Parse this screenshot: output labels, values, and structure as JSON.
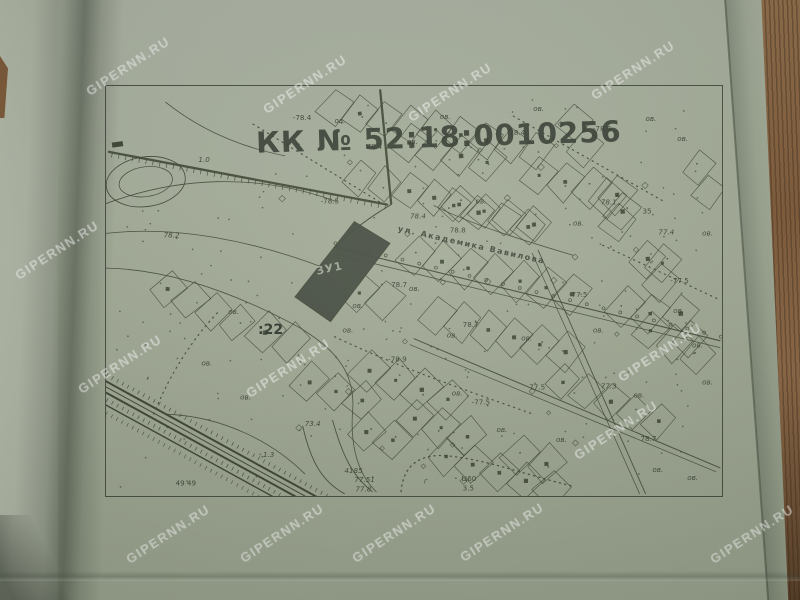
{
  "photo": {
    "watermark_text": "GIPERNN.RU",
    "watermarks": [
      {
        "x": 128,
        "y": 66
      },
      {
        "x": 305,
        "y": 84
      },
      {
        "x": 450,
        "y": 92
      },
      {
        "x": 633,
        "y": 70
      },
      {
        "x": 57,
        "y": 250
      },
      {
        "x": 120,
        "y": 364
      },
      {
        "x": 288,
        "y": 368
      },
      {
        "x": 660,
        "y": 352
      },
      {
        "x": 616,
        "y": 430
      },
      {
        "x": 168,
        "y": 534
      },
      {
        "x": 282,
        "y": 533
      },
      {
        "x": 394,
        "y": 533
      },
      {
        "x": 502,
        "y": 532
      },
      {
        "x": 752,
        "y": 534
      }
    ],
    "colors": {
      "paper": "#a2aa96",
      "ink": "#3a412f",
      "wood": "#7c5634",
      "highlight_parcel": "#434a3e"
    }
  },
  "map": {
    "title": "КК № 52:18:0010256",
    "quarter_label": ":22",
    "highlight_parcel_label": "ЗУ1",
    "street_label": "ул. Академика Вавилова",
    "point_labels": [
      {
        "x": 93,
        "y": 76,
        "t": "1.0",
        "i": 1
      },
      {
        "x": 58,
        "y": 152,
        "t": "78.2",
        "i": 1
      },
      {
        "x": 188,
        "y": 34,
        "t": "-78.4"
      },
      {
        "x": 230,
        "y": 37,
        "t": "ов."
      },
      {
        "x": 262,
        "y": 63,
        "t": "78.4",
        "i": 1
      },
      {
        "x": 303,
        "y": 58,
        "t": "ов."
      },
      {
        "x": 336,
        "y": 33,
        "t": "ов."
      },
      {
        "x": 430,
        "y": 25,
        "t": "ов."
      },
      {
        "x": 406,
        "y": 49,
        "t": "78.4"
      },
      {
        "x": 490,
        "y": 45,
        "t": "-78.6"
      },
      {
        "x": 543,
        "y": 35,
        "t": "ов."
      },
      {
        "x": 575,
        "y": 55,
        "t": "ов."
      },
      {
        "x": 216,
        "y": 118,
        "t": "-78.5"
      },
      {
        "x": 306,
        "y": 133,
        "t": "78.4",
        "i": 1
      },
      {
        "x": 346,
        "y": 147,
        "t": "78.8"
      },
      {
        "x": 372,
        "y": 118,
        "t": "ов."
      },
      {
        "x": 470,
        "y": 140,
        "t": "ов."
      },
      {
        "x": 498,
        "y": 119,
        "t": "78.1",
        "i": 1
      },
      {
        "x": 540,
        "y": 128,
        "t": "35"
      },
      {
        "x": 556,
        "y": 149,
        "t": "77.4",
        "i": 1
      },
      {
        "x": 600,
        "y": 150,
        "t": "ов."
      },
      {
        "x": 466,
        "y": 212,
        "t": "-77.5"
      },
      {
        "x": 568,
        "y": 198,
        "t": "-77.5"
      },
      {
        "x": 287,
        "y": 202,
        "t": "78.7"
      },
      {
        "x": 359,
        "y": 242,
        "t": "78.7"
      },
      {
        "x": 284,
        "y": 277,
        "t": "-78.9"
      },
      {
        "x": 200,
        "y": 342,
        "t": "73.4",
        "i": 1
      },
      {
        "x": 158,
        "y": 373,
        "t": "1.3",
        "i": 1
      },
      {
        "x": 426,
        "y": 305,
        "t": "77.5"
      },
      {
        "x": 368,
        "y": 320,
        "t": "-77.5"
      },
      {
        "x": 498,
        "y": 304,
        "t": "77.3",
        "i": 1
      },
      {
        "x": 538,
        "y": 357,
        "t": "78.7"
      },
      {
        "x": 240,
        "y": 389,
        "t": "4185",
        "i": 1
      },
      {
        "x": 250,
        "y": 398,
        "t": "77.51",
        "i": 1
      },
      {
        "x": 251,
        "y": 408,
        "t": "77.8",
        "i": 1
      },
      {
        "x": 358,
        "y": 397,
        "t": "Ц60"
      },
      {
        "x": 359,
        "y": 407,
        "t": "3.5"
      },
      {
        "x": 320,
        "y": 400,
        "t": "г",
        "i": 1
      },
      {
        "x": 70,
        "y": 402,
        "t": "49 49"
      },
      {
        "x": 123,
        "y": 229,
        "t": "ов."
      },
      {
        "x": 96,
        "y": 281,
        "t": "ов."
      },
      {
        "x": 135,
        "y": 315,
        "t": "ов."
      },
      {
        "x": 248,
        "y": 223,
        "t": "ов."
      },
      {
        "x": 238,
        "y": 248,
        "t": "ов."
      },
      {
        "x": 305,
        "y": 206,
        "t": "ов."
      },
      {
        "x": 343,
        "y": 253,
        "t": "ов."
      },
      {
        "x": 348,
        "y": 311,
        "t": "ов."
      },
      {
        "x": 393,
        "y": 348,
        "t": "ов."
      },
      {
        "x": 453,
        "y": 358,
        "t": "ов."
      },
      {
        "x": 490,
        "y": 248,
        "t": "ов."
      },
      {
        "x": 418,
        "y": 256,
        "t": "ов."
      },
      {
        "x": 531,
        "y": 313,
        "t": "ов."
      },
      {
        "x": 571,
        "y": 228,
        "t": "ов."
      },
      {
        "x": 590,
        "y": 263,
        "t": "ов."
      },
      {
        "x": 550,
        "y": 388,
        "t": "ов."
      },
      {
        "x": 585,
        "y": 396,
        "t": "ов."
      },
      {
        "x": 600,
        "y": 300,
        "t": "ов."
      }
    ]
  }
}
